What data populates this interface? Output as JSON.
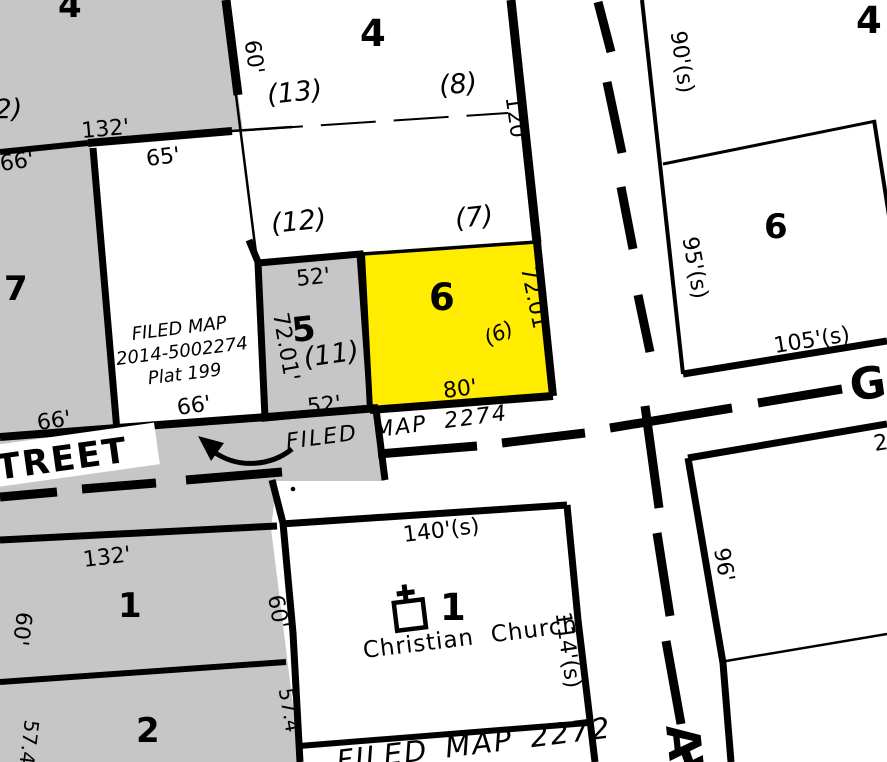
{
  "map": {
    "kind": "tax-parcel-map",
    "highlighted_lot": "6",
    "street_horizontal_name_partial": "TREET",
    "street_horizontal_east_initial": "G",
    "street_vertical_name_partial": "AV"
  },
  "colors": {
    "background": "#ffffff",
    "block_gray": "#c6c6c6",
    "highlight_yellow": "#ffec00",
    "line": "#000000"
  },
  "labels": {
    "blk_tl_4": "4",
    "lot2_paren": "(2)",
    "dim_132_top": "132'",
    "dim_66_tl": "66'",
    "dim_65": "65'",
    "dim_60_top": "60'",
    "blk_mid_4": "4",
    "lot13": "(13)",
    "lot8": "(8)",
    "lot12": "(12)",
    "lot7_paren": "(7)",
    "dim_120": "120'",
    "lot7": "7",
    "fm2014_l1": "FILED MAP",
    "fm2014_l2": "2014-5002274",
    "fm2014_l3": "Plat 199",
    "dim_66_p7": "66'",
    "dim_66_fm": "66'",
    "dim_52_top": "52'",
    "lot5": "5",
    "lot11": "(11)",
    "dim_7201_w": "72.01'",
    "dim_52_bot": "52'",
    "lot6_yellow": "6",
    "lot6_paren": "(6)",
    "dim_7201_e": "72.01'",
    "dim_80": "80'",
    "dim_90s": "90'(s)",
    "blk_tr_4": "4",
    "lot6_right": "6",
    "dim_95s": "95'(s)",
    "dim_105s": "105'(s)",
    "street_g": "G",
    "dim_2_edge": "2",
    "dim_96": "96'",
    "street_treet": "TREET",
    "fm2274": "FILED MAP 2274",
    "dim_140s": "140'(s)",
    "lot1_church": "1",
    "church_name": "Christian Church",
    "dim_114s": "114'(s)",
    "fm2272": "FILED MAP 2272",
    "dim_132_bot": "132'",
    "lot1_gray": "1",
    "dim_60_l": "60'",
    "dim_60_r": "60'",
    "lot2_gray": "2",
    "dim_574_l": "57.4'",
    "dim_574_r": "57.4'",
    "street_av": "AV"
  }
}
